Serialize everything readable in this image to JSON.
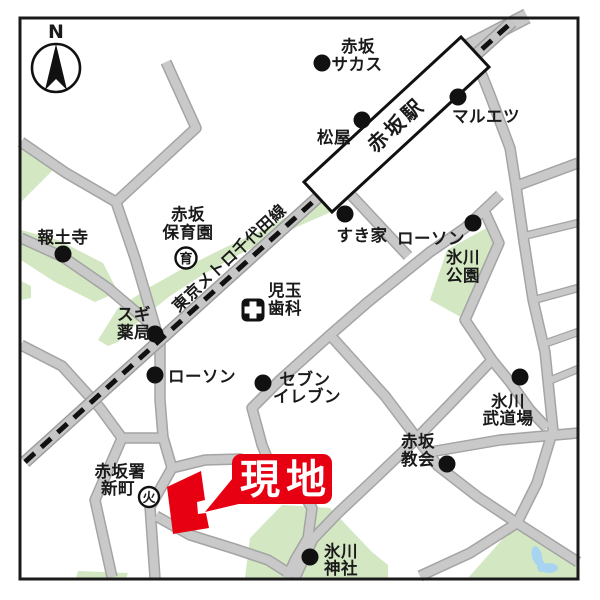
{
  "compass": {
    "label": "N"
  },
  "station": {
    "label": "赤坂駅"
  },
  "railway": {
    "label": "東京メトロ千代田線"
  },
  "callout": {
    "label": "現地"
  },
  "colors": {
    "road": "#c9c9c9",
    "road_edge": "#a4a4a4",
    "green": "#d2e7c2",
    "water": "#a9d4f1",
    "accent_red": "#e60012",
    "rail_dash": "#111111"
  },
  "pois": {
    "sacas": {
      "line1": "赤坂",
      "line2": "サカス"
    },
    "matsuya": {
      "line1": "松屋"
    },
    "maruetsu": {
      "line1": "マルエツ"
    },
    "sukiya": {
      "line1": "すき家"
    },
    "lawson_upper": {
      "line1": "ローソン"
    },
    "hodoji": {
      "line1": "報土寺"
    },
    "hoikuen": {
      "line1": "赤坂",
      "line2": "保育園",
      "icon": "育"
    },
    "sugi": {
      "line1": "スギ",
      "line2": "薬局"
    },
    "kodama": {
      "line1": "児玉",
      "line2": "歯科"
    },
    "hikawa_park": {
      "line1": "氷川",
      "line2": "公園"
    },
    "lawson_lower": {
      "line1": "ローソン"
    },
    "seven": {
      "line1": "セブン",
      "line2": "イレブン"
    },
    "budojo": {
      "line1": "氷川",
      "line2": "武道場"
    },
    "kyokai": {
      "line1": "赤坂",
      "line2": "教会"
    },
    "shinmachi": {
      "line1": "赤坂署",
      "line2": "新町",
      "icon": "火"
    },
    "jinja": {
      "line1": "氷川",
      "line2": "神社"
    }
  }
}
